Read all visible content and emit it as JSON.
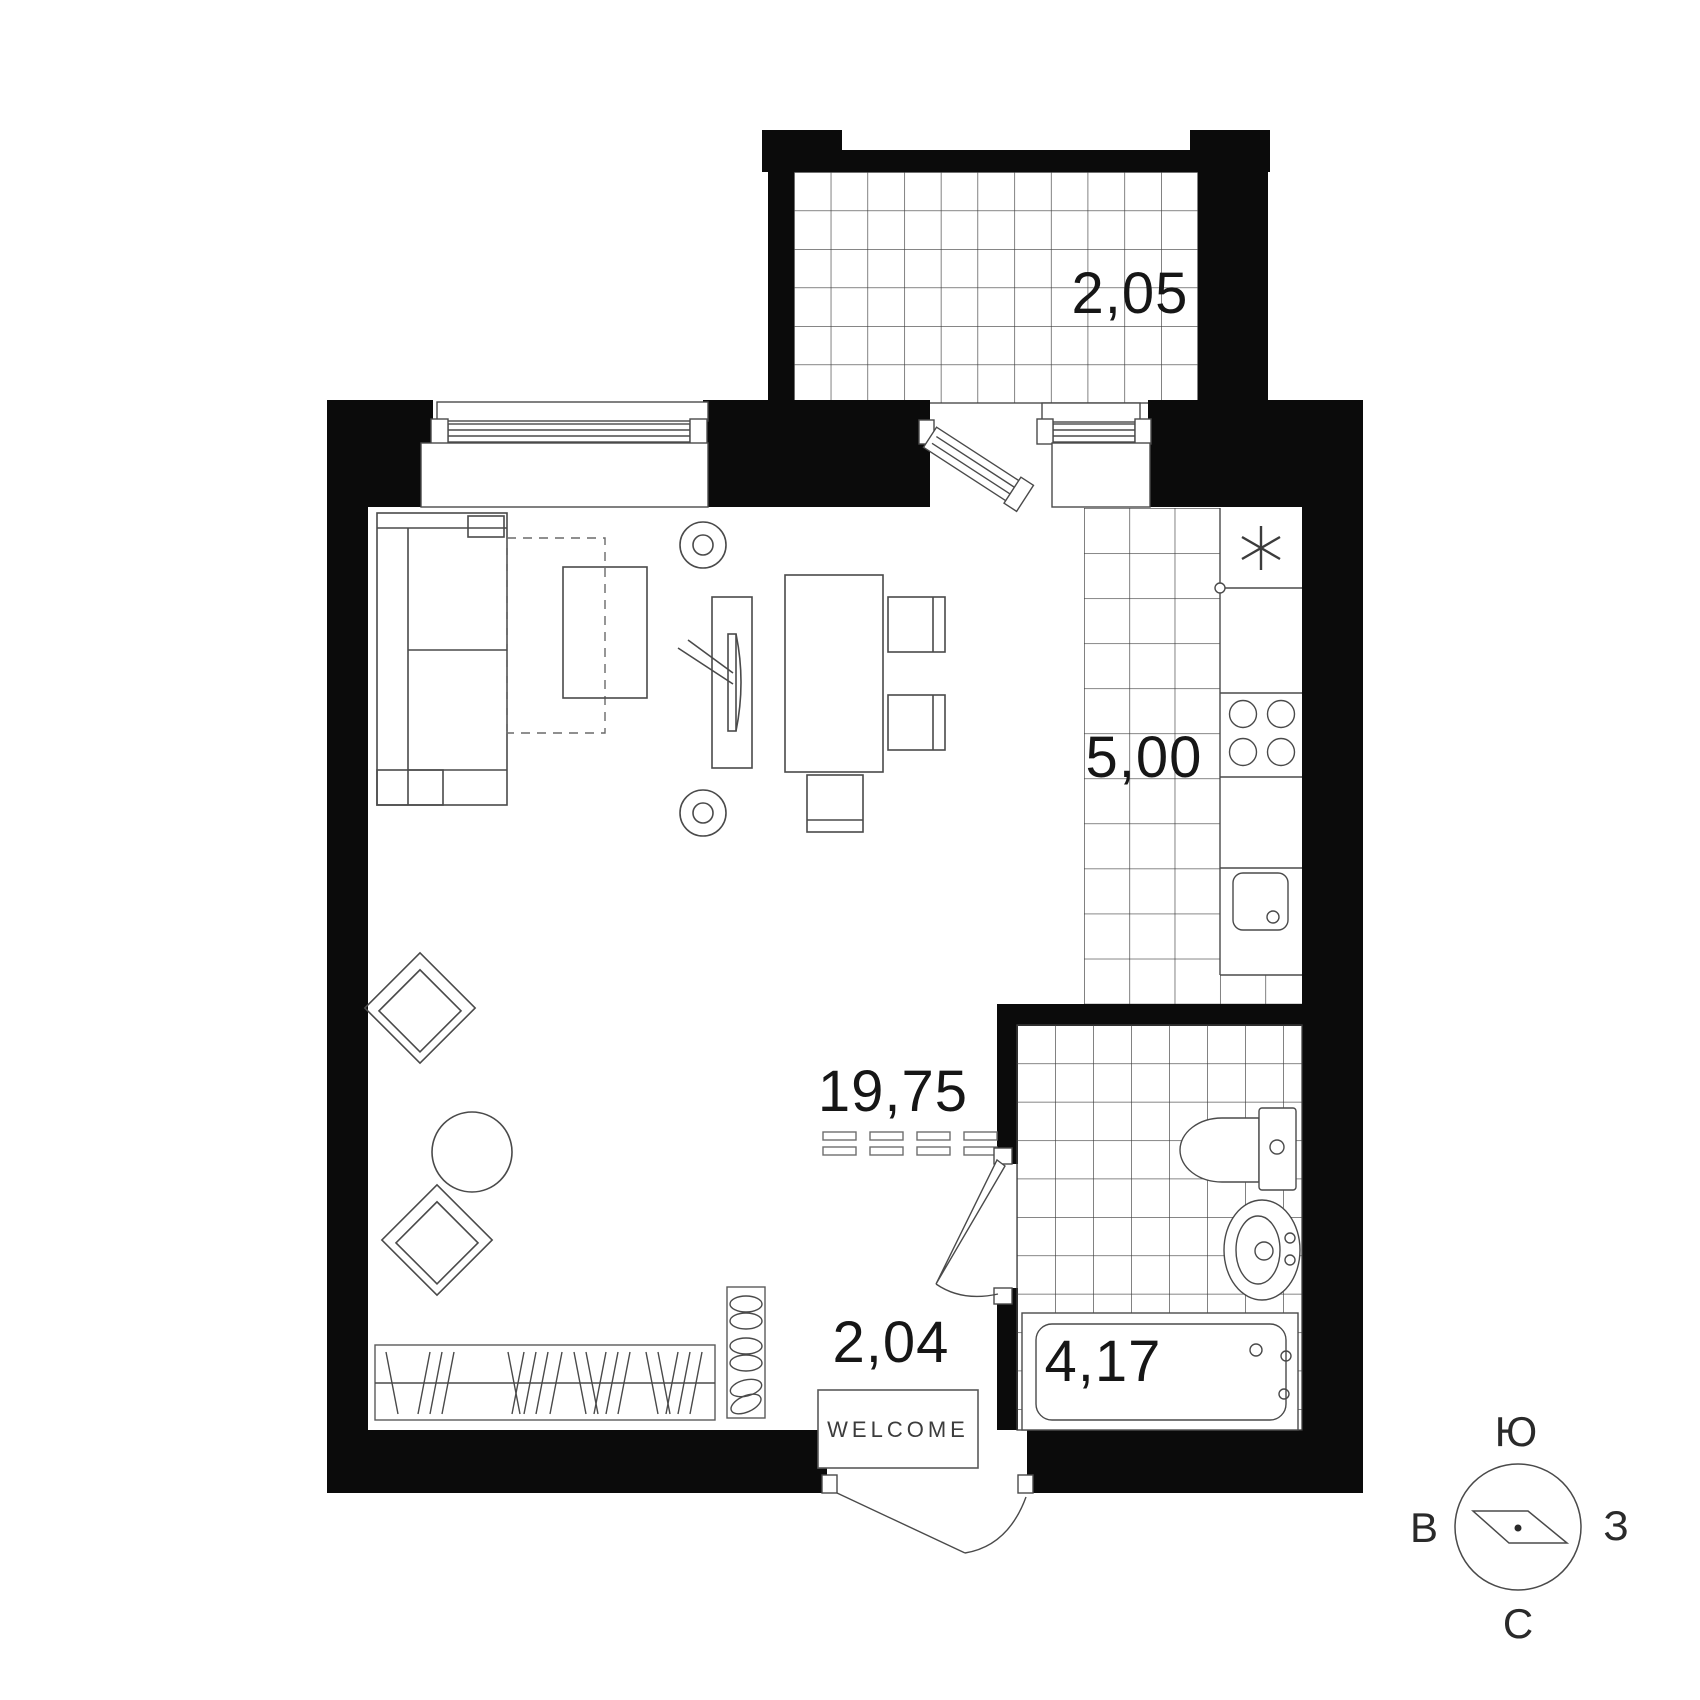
{
  "plan": {
    "type": "apartment-floor-plan",
    "rooms": [
      {
        "id": "balcony",
        "area_label": "2,05"
      },
      {
        "id": "kitchen",
        "area_label": "5,00"
      },
      {
        "id": "living-room",
        "area_label": "19,75"
      },
      {
        "id": "hallway",
        "area_label": "2,04"
      },
      {
        "id": "bathroom",
        "area_label": "4,17"
      }
    ],
    "door_mat_text": "WELCOME",
    "compass": {
      "top": "Ю",
      "left": "В",
      "right": "З",
      "bottom": "С"
    },
    "colors": {
      "wall": "#0b0b0b",
      "tile_line": "#3e3e3e",
      "furniture_line": "#4a4a4a",
      "text": "#161616",
      "background": "#ffffff"
    }
  }
}
